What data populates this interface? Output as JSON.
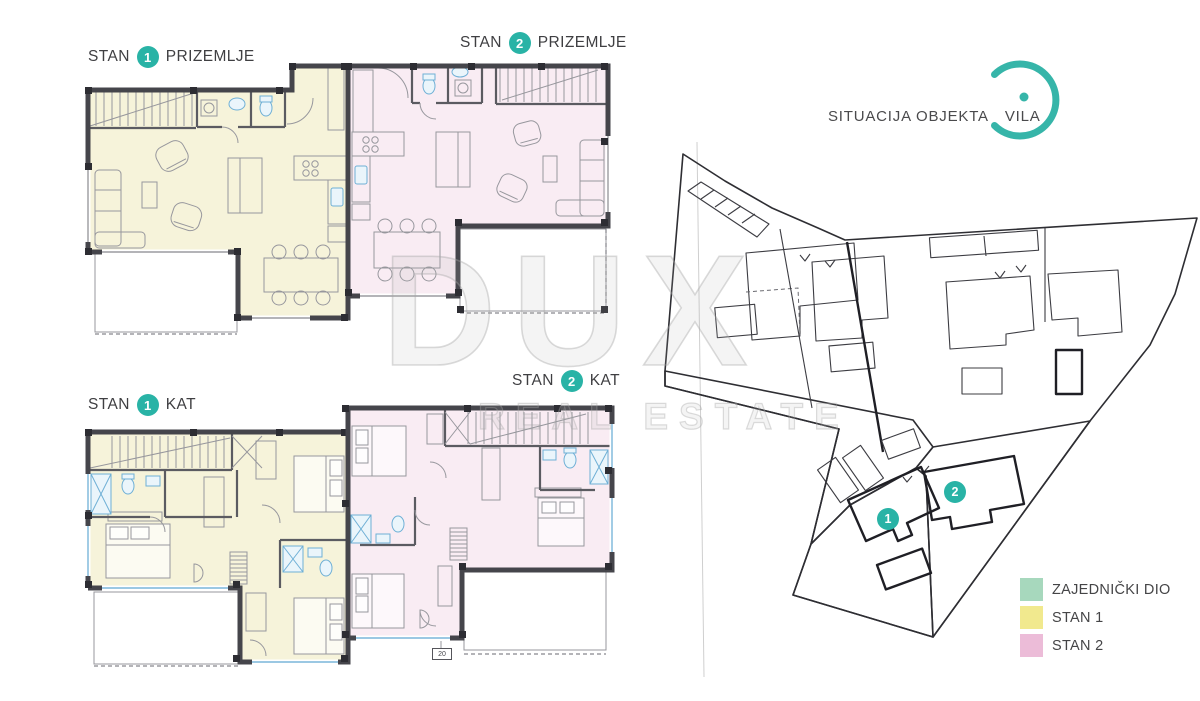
{
  "plans": [
    {
      "prefix": "STAN",
      "unit": "1",
      "level": "PRIZEMLJE"
    },
    {
      "prefix": "STAN",
      "unit": "2",
      "level": "PRIZEMLJE"
    },
    {
      "prefix": "STAN",
      "unit": "1",
      "level": "KAT"
    },
    {
      "prefix": "STAN",
      "unit": "2",
      "level": "KAT"
    }
  ],
  "site": {
    "title_left": "SITUACIJA OBJEKTA",
    "title_right": "VILA",
    "markers": [
      {
        "number": "1"
      },
      {
        "number": "2"
      }
    ]
  },
  "legend": {
    "items": [
      {
        "label": "ZAJEDNIČKI DIO",
        "color": "#a7d8bd"
      },
      {
        "label": "STAN 1",
        "color": "#f1e98e"
      },
      {
        "label": "STAN 2",
        "color": "#ecbcd8"
      }
    ]
  },
  "watermark": {
    "line1": "DUX",
    "line2": "REAL ESTATE"
  },
  "annotations": {
    "dimension_tag": "20"
  },
  "colors": {
    "accent_teal": "#29b3a6",
    "plan_fill_stan1": "#f6f3da",
    "plan_fill_stan2": "#f9ecf3",
    "site_green": "#c2e2cf",
    "site_yellow": "#f5efb6",
    "site_pink": "#dfa9c9",
    "wall": "#45454b",
    "window_blue": "#7ab6da"
  }
}
